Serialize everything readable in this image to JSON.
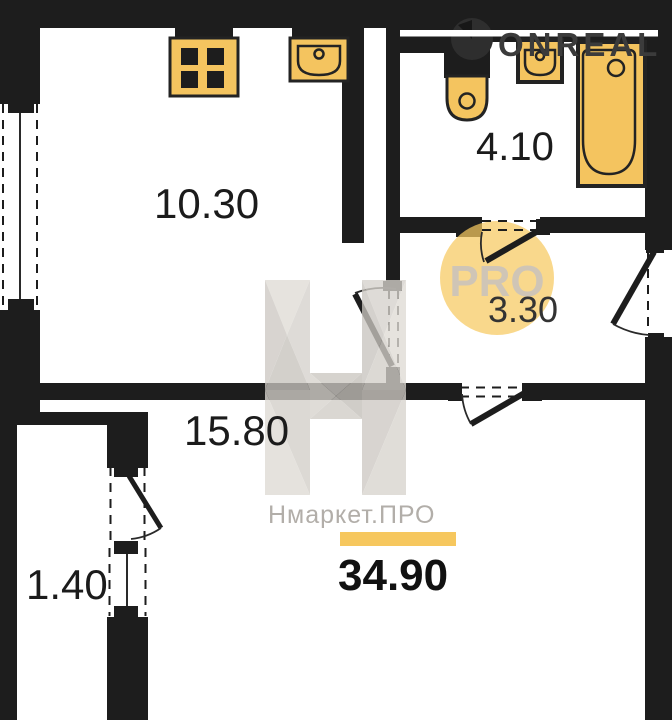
{
  "branding": {
    "watermark_logo_text": "ONREAL",
    "brand_name": "Нмаркет.ПРО",
    "badge_text": "PRO"
  },
  "areas": {
    "total": "34.90",
    "kitchen_living": "10.30",
    "bathroom": "4.10",
    "hallway": "3.30",
    "room": "15.80",
    "balcony": "1.40"
  },
  "colors": {
    "wall": "#1d1d1d",
    "fixture": "#f4c45f",
    "accent": "#f6c75e",
    "badge": "#f7c95f",
    "brand_text": "#b2aea9"
  }
}
